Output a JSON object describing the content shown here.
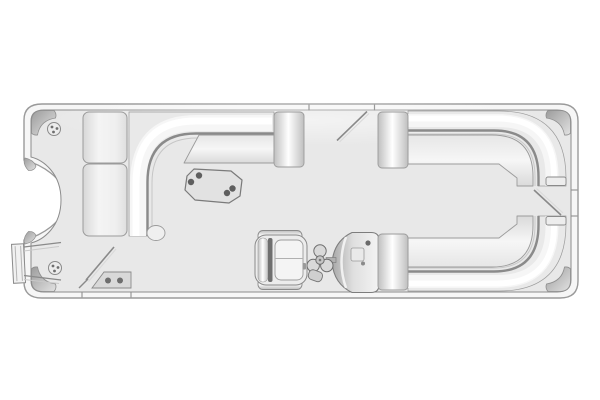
{
  "diagram": {
    "kind": "pontoon-boat-floorplan-top-view",
    "orientation": "bow-left-stern-right"
  },
  "colors": {
    "page_bg": "#ffffff",
    "rail": "#f6f6f6",
    "rail_stroke": "#9a9a9a",
    "deck": "#e8e8e8",
    "deck_stroke": "#8c8c8c",
    "seat_band": "#e9e9e9",
    "seat_stroke": "#9b9b9b",
    "backrest_line": "#8a8a8a",
    "table_fill": "#e2e2e2",
    "table_stroke": "#7a7a7a",
    "cupholder": "#5f5f5f",
    "pad_fill": "#d9d9d9",
    "chair_seam": "#6f6f6f"
  },
  "components": [
    "hull-rub-rail",
    "deck",
    "bow-walkway",
    "boarding-ladder",
    "port-bow-gate",
    "gate-step-pad",
    "bow-lounge-side-seat",
    "bow-lounge-top-seat",
    "wraparound-backrest",
    "bow-armrest",
    "cocktail-table",
    "cup-holders",
    "captains-chair",
    "helm-console",
    "steering-wheel",
    "throttle",
    "port-side-gate",
    "stern-lounge-top",
    "stern-lounge-bottom",
    "stern-gate",
    "corner-caps",
    "deck-fittings"
  ],
  "dots": {
    "table_cupholders": [
      {
        "x": 191,
        "y": 182
      },
      {
        "x": 199,
        "y": 175.5
      },
      {
        "x": 227,
        "y": 193
      },
      {
        "x": 232.5,
        "y": 188.5
      }
    ],
    "gate_step_pad": [
      {
        "x": 108,
        "y": 280.5
      },
      {
        "x": 120,
        "y": 280.5
      }
    ],
    "bow_fitting": [
      {
        "x": 52,
        "y": 127
      },
      {
        "x": 57,
        "y": 128.5
      },
      {
        "x": 53.5,
        "y": 132
      }
    ],
    "midship_fitting": [
      {
        "x": 53,
        "y": 266
      },
      {
        "x": 58,
        "y": 267.5
      },
      {
        "x": 54.5,
        "y": 271
      }
    ]
  }
}
